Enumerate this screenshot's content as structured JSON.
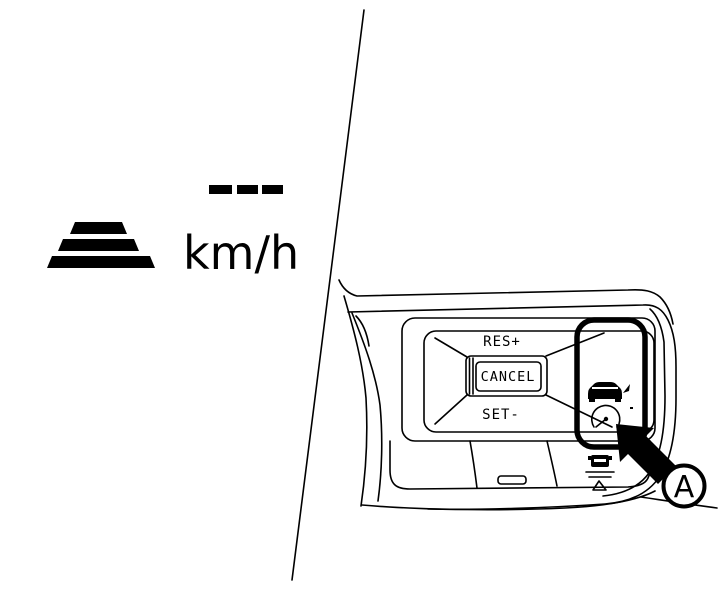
{
  "figure": {
    "background_color": "#ffffff",
    "line_color": "#000000",
    "meter_display": {
      "set_speed_value": "---",
      "unit_label": "km/h",
      "distance_icon": "following-distance-bars-icon"
    },
    "steering_switches": {
      "res_label": "RES+",
      "cancel_label": "CANCEL",
      "set_label": "SET-",
      "acc_icon": "cruise-control-car-gauge-icon",
      "distance_button_icon": "set-distance-button-icon"
    },
    "callout": {
      "label": "A",
      "arrow": "callout-arrow-up-left-icon"
    }
  }
}
